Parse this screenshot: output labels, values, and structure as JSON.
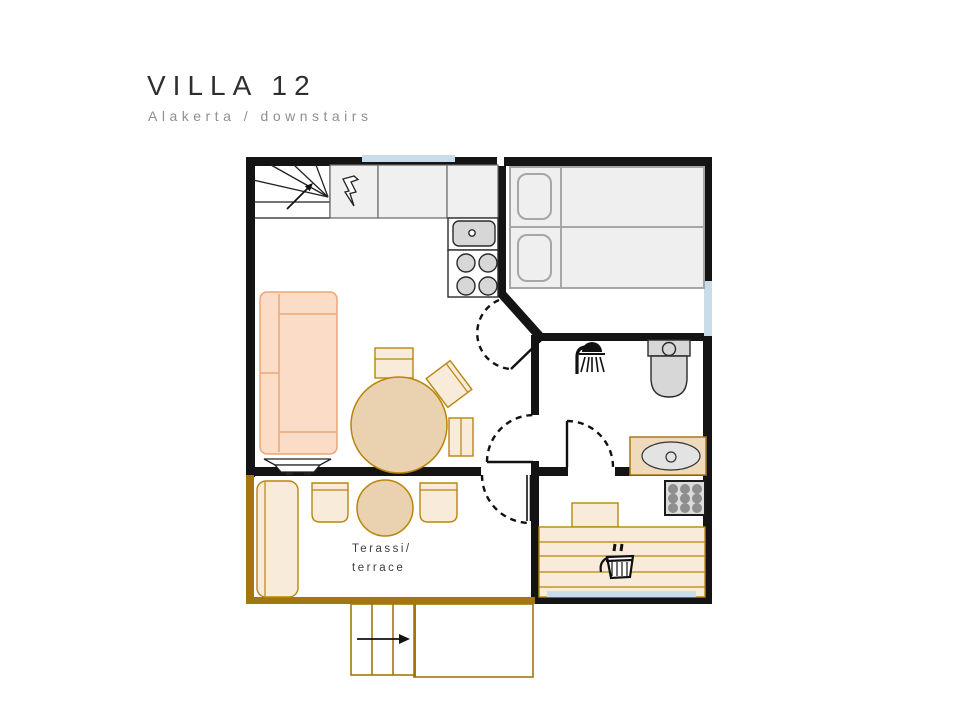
{
  "header": {
    "title": "VILLA 12",
    "subtitle": "Alakerta / downstairs"
  },
  "plan": {
    "terrace_label": {
      "line1": "Terassi/",
      "line2": "terrace"
    },
    "icons": {
      "staircase": "stairs-up-arrow",
      "electrical": "lightning-bolt",
      "kitchen_sink": "sink-basin",
      "stove": "cooktop-4-burners",
      "shower": "shower-head",
      "toilet": "toilet-seat",
      "washbasin": "oval-basin",
      "sauna_heater": "heater-stones-grid",
      "sauna_bucket": "sauna-bucket-ladle",
      "entry": "entry-direction-arrow"
    }
  },
  "colors": {
    "wall": "#141414",
    "terrace_wall": "#A1770E",
    "window": "#C8DDE9",
    "peach_fill": "#FBDCC6",
    "peach_stroke": "#E8A87C",
    "wood_fill": "#EAD1B0",
    "wood_light_fill": "#F8EBDA",
    "wood_stroke": "#B8860B",
    "counter_fill": "#F0F0F0",
    "counter_stroke": "#666666",
    "fixture_fill": "#D7D7D7",
    "fixture_stroke": "#2A2A2A",
    "bed_fill": "#EFEFEF",
    "bed_stroke": "#A6A6A6",
    "basin_counter_fill": "#EFDABC",
    "basin_counter_stroke": "#A8791C",
    "stone_fill": "#8E8E8E",
    "text_dark": "#2F2F2F",
    "text_gray": "#8F8F8F",
    "label_gray": "#3D3D3D"
  }
}
